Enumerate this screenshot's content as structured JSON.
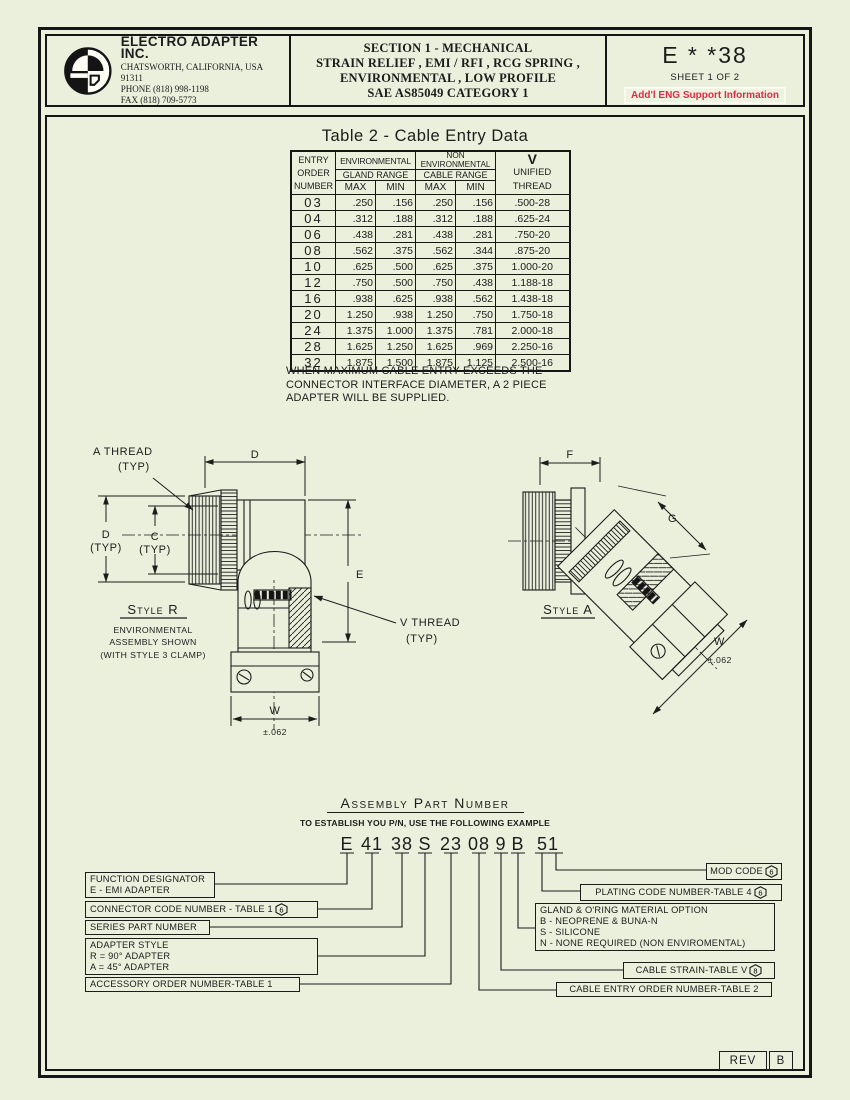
{
  "colors": {
    "background": "#eaf0dc",
    "ink": "#1c1c1c",
    "accent_red": "#e02a48"
  },
  "header": {
    "company_name": "ELECTRO ADAPTER INC.",
    "company_address": "CHATSWORTH, CALIFORNIA, USA 91311",
    "company_phone": "PHONE   (818) 998-1198",
    "company_fax": "FAX   (818) 709-5773",
    "section_lines": [
      "SECTION 1  -  MECHANICAL",
      "STRAIN RELIEF ,  EMI / RFI ,  RCG SPRING ,",
      "ENVIRONMENTAL ,  LOW PROFILE",
      "SAE AS85049 CATEGORY 1"
    ],
    "doc_code": "E * *38",
    "sheet_label": "SHEET  1 OF 2",
    "eng_support": "Add'l ENG Support Information"
  },
  "cable_table": {
    "title": "Table  2  -   Cable Entry Data",
    "head": {
      "entry_l1": "ENTRY",
      "entry_l2": "ORDER",
      "entry_l3": "NUMBER",
      "env": "ENVIRONMENTAL",
      "env_sub": "GLAND  RANGE",
      "nonenv_l1": "NON",
      "nonenv_l2": "ENVIRONMENTAL",
      "nonenv_sub": "CABLE  RANGE",
      "max1": "MAX",
      "min1": "MIN",
      "max2": "MAX",
      "min2": "MIN",
      "v_l1": "V",
      "v_l2": "UNIFIED",
      "v_l3": "THREAD"
    },
    "rows": [
      {
        "entry": "03",
        "gmax": ".250",
        "gmin": ".156",
        "cmax": ".250",
        "cmin": ".156",
        "thread": ".500-28"
      },
      {
        "entry": "04",
        "gmax": ".312",
        "gmin": ".188",
        "cmax": ".312",
        "cmin": ".188",
        "thread": ".625-24"
      },
      {
        "entry": "06",
        "gmax": ".438",
        "gmin": ".281",
        "cmax": ".438",
        "cmin": ".281",
        "thread": ".750-20"
      },
      {
        "entry": "08",
        "gmax": ".562",
        "gmin": ".375",
        "cmax": ".562",
        "cmin": ".344",
        "thread": ".875-20"
      },
      {
        "entry": "10",
        "gmax": ".625",
        "gmin": ".500",
        "cmax": ".625",
        "cmin": ".375",
        "thread": "1.000-20"
      },
      {
        "entry": "12",
        "gmax": ".750",
        "gmin": ".500",
        "cmax": ".750",
        "cmin": ".438",
        "thread": "1.188-18"
      },
      {
        "entry": "16",
        "gmax": ".938",
        "gmin": ".625",
        "cmax": ".938",
        "cmin": ".562",
        "thread": "1.438-18"
      },
      {
        "entry": "20",
        "gmax": "1.250",
        "gmin": ".938",
        "cmax": "1.250",
        "cmin": ".750",
        "thread": "1.750-18"
      },
      {
        "entry": "24",
        "gmax": "1.375",
        "gmin": "1.000",
        "cmax": "1.375",
        "cmin": ".781",
        "thread": "2.000-18"
      },
      {
        "entry": "28",
        "gmax": "1.625",
        "gmin": "1.250",
        "cmax": "1.625",
        "cmin": ".969",
        "thread": "2.250-16"
      },
      {
        "entry": "32",
        "gmax": "1.875",
        "gmin": "1.500",
        "cmax": "1.875",
        "cmin": "1.125",
        "thread": "2.500-16"
      }
    ],
    "note_lines": [
      "WHEN MAXIMUM CABLE ENTRY EXCEEDS THE",
      "CONNECTOR INTERFACE DIAMETER, A  2  PIECE",
      "ADAPTER WILL BE SUPPLIED."
    ]
  },
  "drawings": {
    "style_r": {
      "a_thread_l1": "A  THREAD",
      "a_thread_l2": "(TYP)",
      "dim_d_top": "D",
      "dim_d_l1": "D",
      "dim_d_l2": "(TYP)",
      "dim_c_l1": "C",
      "dim_c_l2": "(TYP)",
      "dim_e": "E",
      "v_thread_l1": "V  THREAD",
      "v_thread_l2": "(TYP)",
      "dim_w": "W",
      "dim_w_tol": "±.062",
      "caption": "Style R",
      "sub_l1": "ENVIRONMENTAL",
      "sub_l2": "ASSEMBLY  SHOWN",
      "sub_l3": "(WITH  STYLE  3  CLAMP)"
    },
    "style_a": {
      "dim_f": "F",
      "dim_g": "G",
      "dim_w": "W",
      "dim_w_tol": "±.062",
      "caption": "Style A"
    }
  },
  "assembly": {
    "title": "Assembly Part Number",
    "subtitle": "TO ESTABLISH YOU P/N, USE THE FOLLOWING EXAMPLE",
    "segments": [
      "E",
      "41",
      "38",
      "S",
      "23",
      "08",
      "9",
      "B",
      "51"
    ],
    "callouts_left": [
      {
        "lines": [
          "FUNCTION DESIGNATOR",
          "E - EMI ADAPTER"
        ]
      },
      {
        "lines": [
          "CONNECTOR CODE NUMBER - TABLE 1"
        ],
        "flag": "6"
      },
      {
        "lines": [
          "SERIES PART NUMBER"
        ]
      },
      {
        "lines": [
          "ADAPTER STYLE",
          "R = 90° ADAPTER",
          "A = 45° ADAPTER"
        ]
      },
      {
        "lines": [
          "ACCESSORY ORDER NUMBER-TABLE 1"
        ]
      }
    ],
    "callouts_right": [
      {
        "lines": [
          "MOD CODE"
        ],
        "flag": "6"
      },
      {
        "lines": [
          "PLATING CODE NUMBER-TABLE 4"
        ],
        "flag": "6"
      },
      {
        "lines": [
          "GLAND & O'RING MATERIAL OPTION",
          "B - NEOPRENE & BUNA-N",
          "S - SILICONE",
          "N - NONE REQUIRED (NON ENVIROMENTAL)"
        ]
      },
      {
        "lines": [
          "CABLE STRAIN-TABLE V"
        ],
        "flag": "8"
      },
      {
        "lines": [
          "CABLE ENTRY ORDER NUMBER-TABLE 2"
        ]
      }
    ]
  },
  "footer": {
    "rev_label": "REV",
    "rev_value": "B"
  }
}
